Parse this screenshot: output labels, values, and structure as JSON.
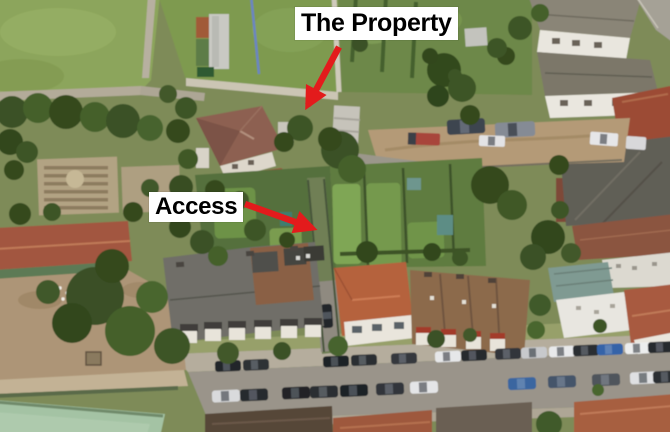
{
  "annotations": {
    "property": {
      "label": "The Property"
    },
    "access": {
      "label": "Access"
    }
  },
  "style": {
    "arrow_color": "#e31b1c",
    "label_bg": "#ffffff",
    "label_text": "#000000"
  },
  "scene": {
    "palette": {
      "grass_field": "#8ca55b",
      "garden_green": "#5f7b40",
      "tree_green": "#3a5126",
      "dirt_tan": "#ad9577",
      "road_gray": "#9a948a",
      "roof_terracotta": "#a2563f",
      "roof_slate": "#6f6e68",
      "bowling_green": "#a4c3a4"
    }
  }
}
